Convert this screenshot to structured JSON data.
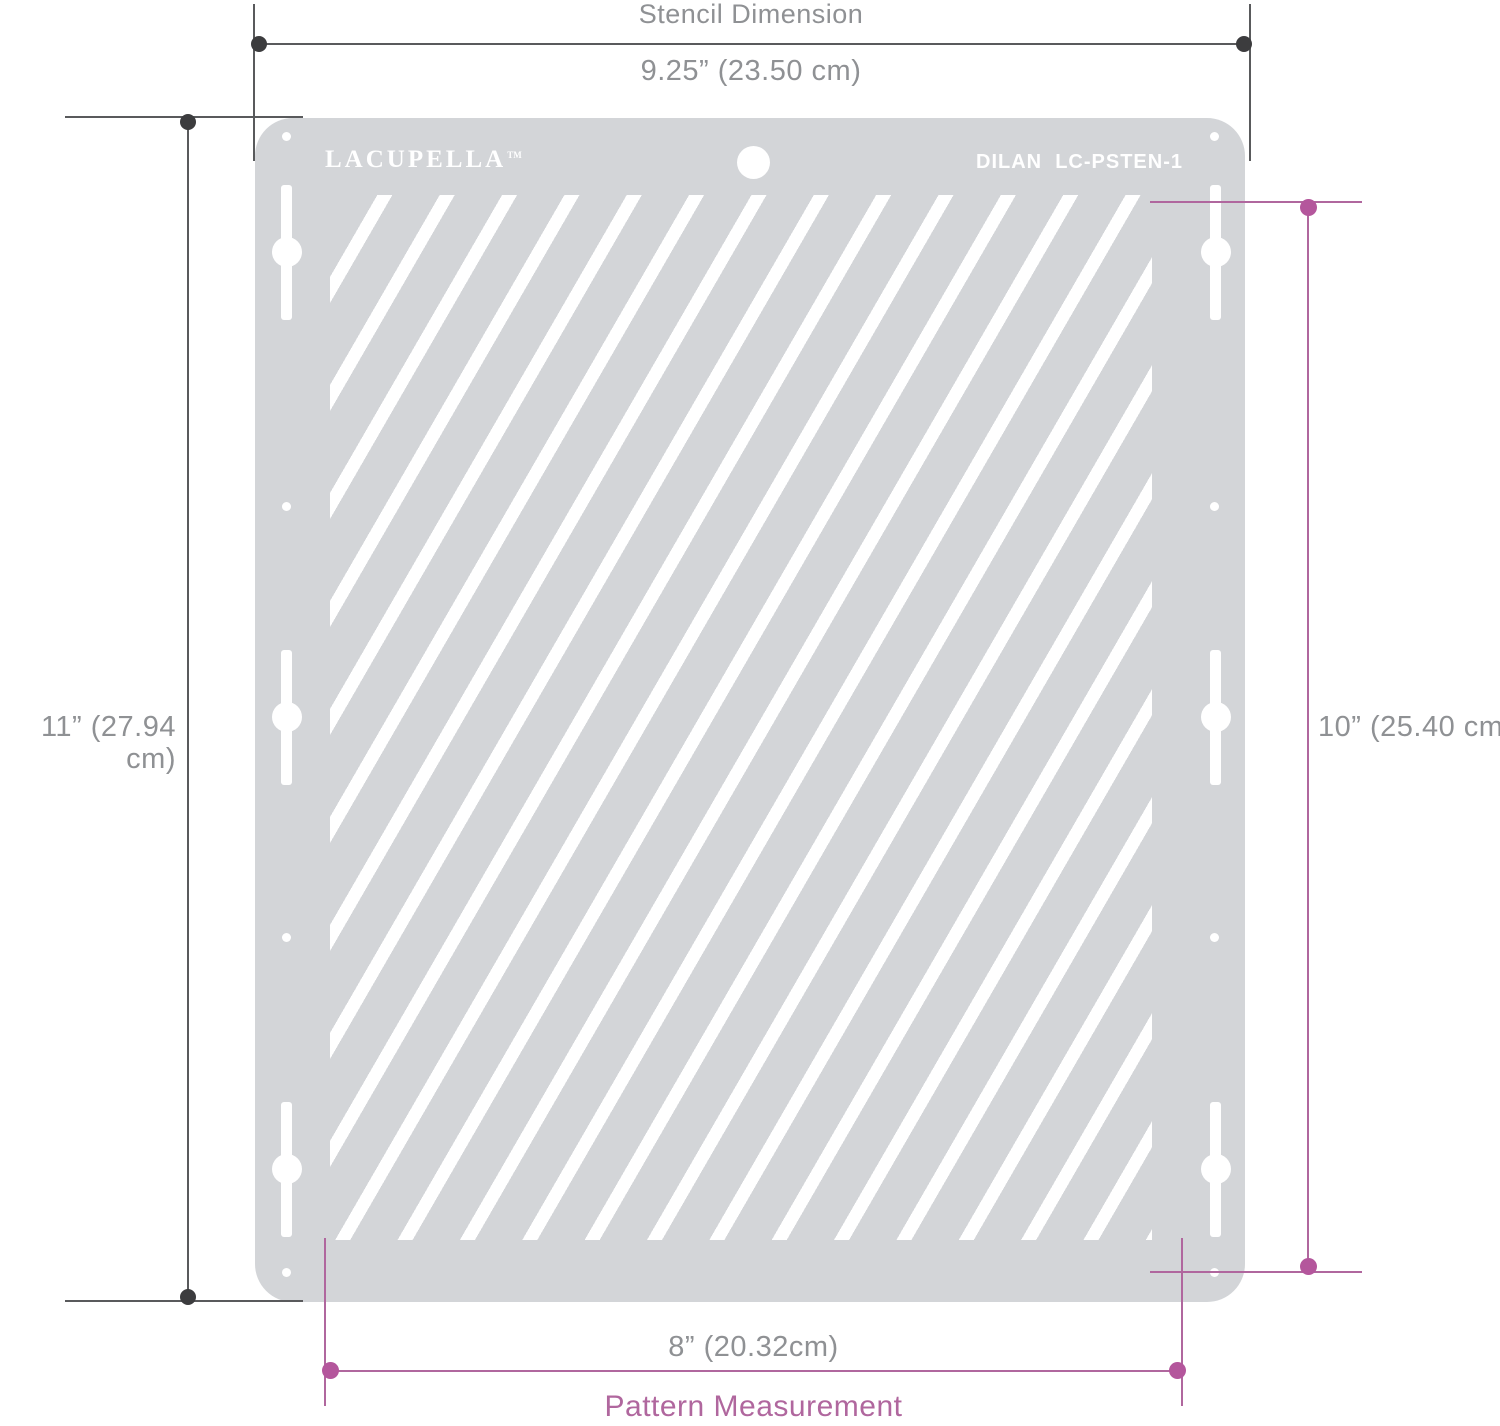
{
  "page": {
    "background": "#ffffff"
  },
  "stencil_plate": {
    "brand": "LACUPELLA",
    "brand_trademark": "TM",
    "model_text": "DILAN  LC-PSTEN-1",
    "plate_color": "#d3d5d8",
    "stripe_color": "#ffffff",
    "pattern": "diagonal-stripes"
  },
  "annotations": {
    "stencil_dimension": {
      "title": "Stencil Dimension",
      "width_value": "9.25” (23.50 cm)",
      "height_value": "11” (27.94 cm)",
      "line_color": "#595a5c",
      "dot_color": "#3c3c3e",
      "text_color": "#8f9194"
    },
    "pattern_measurement": {
      "title": "Pattern Measurement",
      "width_value": "8” (20.32cm)",
      "height_value": "10” (25.40 cm)",
      "accent_color": "#b0679e"
    }
  }
}
